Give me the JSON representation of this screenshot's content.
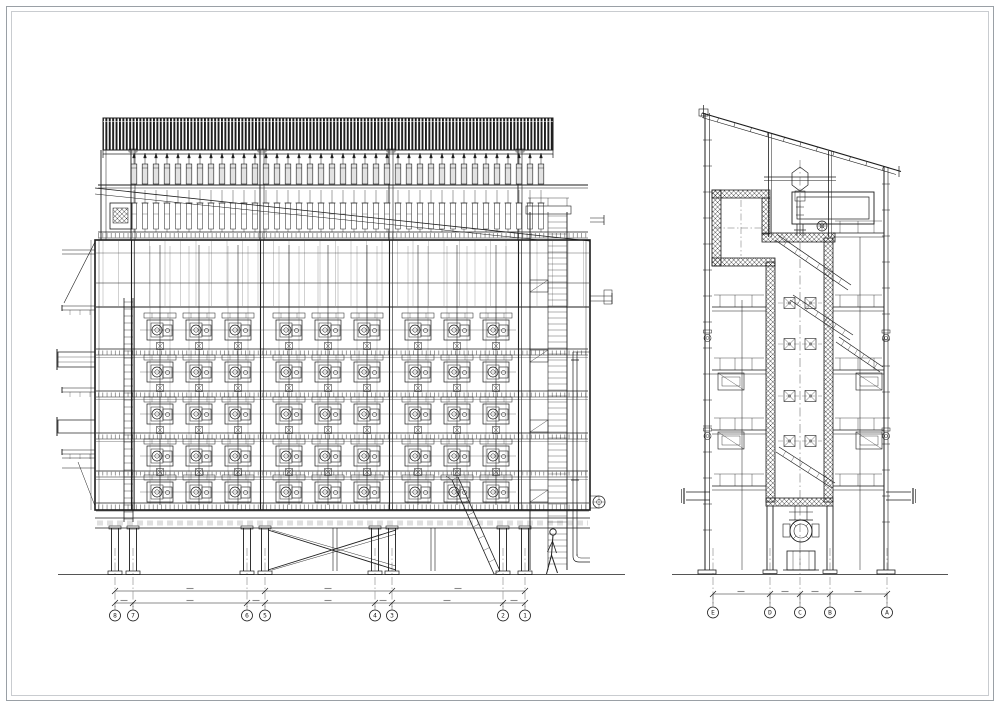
{
  "sheet": {
    "background": "#ffffff",
    "frame_outer_color": "#9aa0a6",
    "frame_inner_color": "#c9ccd0",
    "ink": "#1c1c1c",
    "ink_mid": "#444444",
    "ink_light": "#777777",
    "fill_light": "#e2e2e2",
    "hint_color": "#8a8a8a"
  },
  "views": {
    "elevation": {
      "label": "side-elevation-view",
      "grid_markers": [
        "8",
        "7",
        "6",
        "5",
        "4",
        "3",
        "2",
        "1"
      ],
      "bushing_count": 38,
      "rapper_rows": 5,
      "rapper_bays": 3,
      "rappers_per_bay": 3,
      "has_worker_figure": true
    },
    "section": {
      "label": "cross-section-view",
      "grid_markers": [
        "E",
        "D",
        "C",
        "B",
        "A"
      ],
      "damper_levels": 4,
      "dampers_per_level": 2
    }
  }
}
